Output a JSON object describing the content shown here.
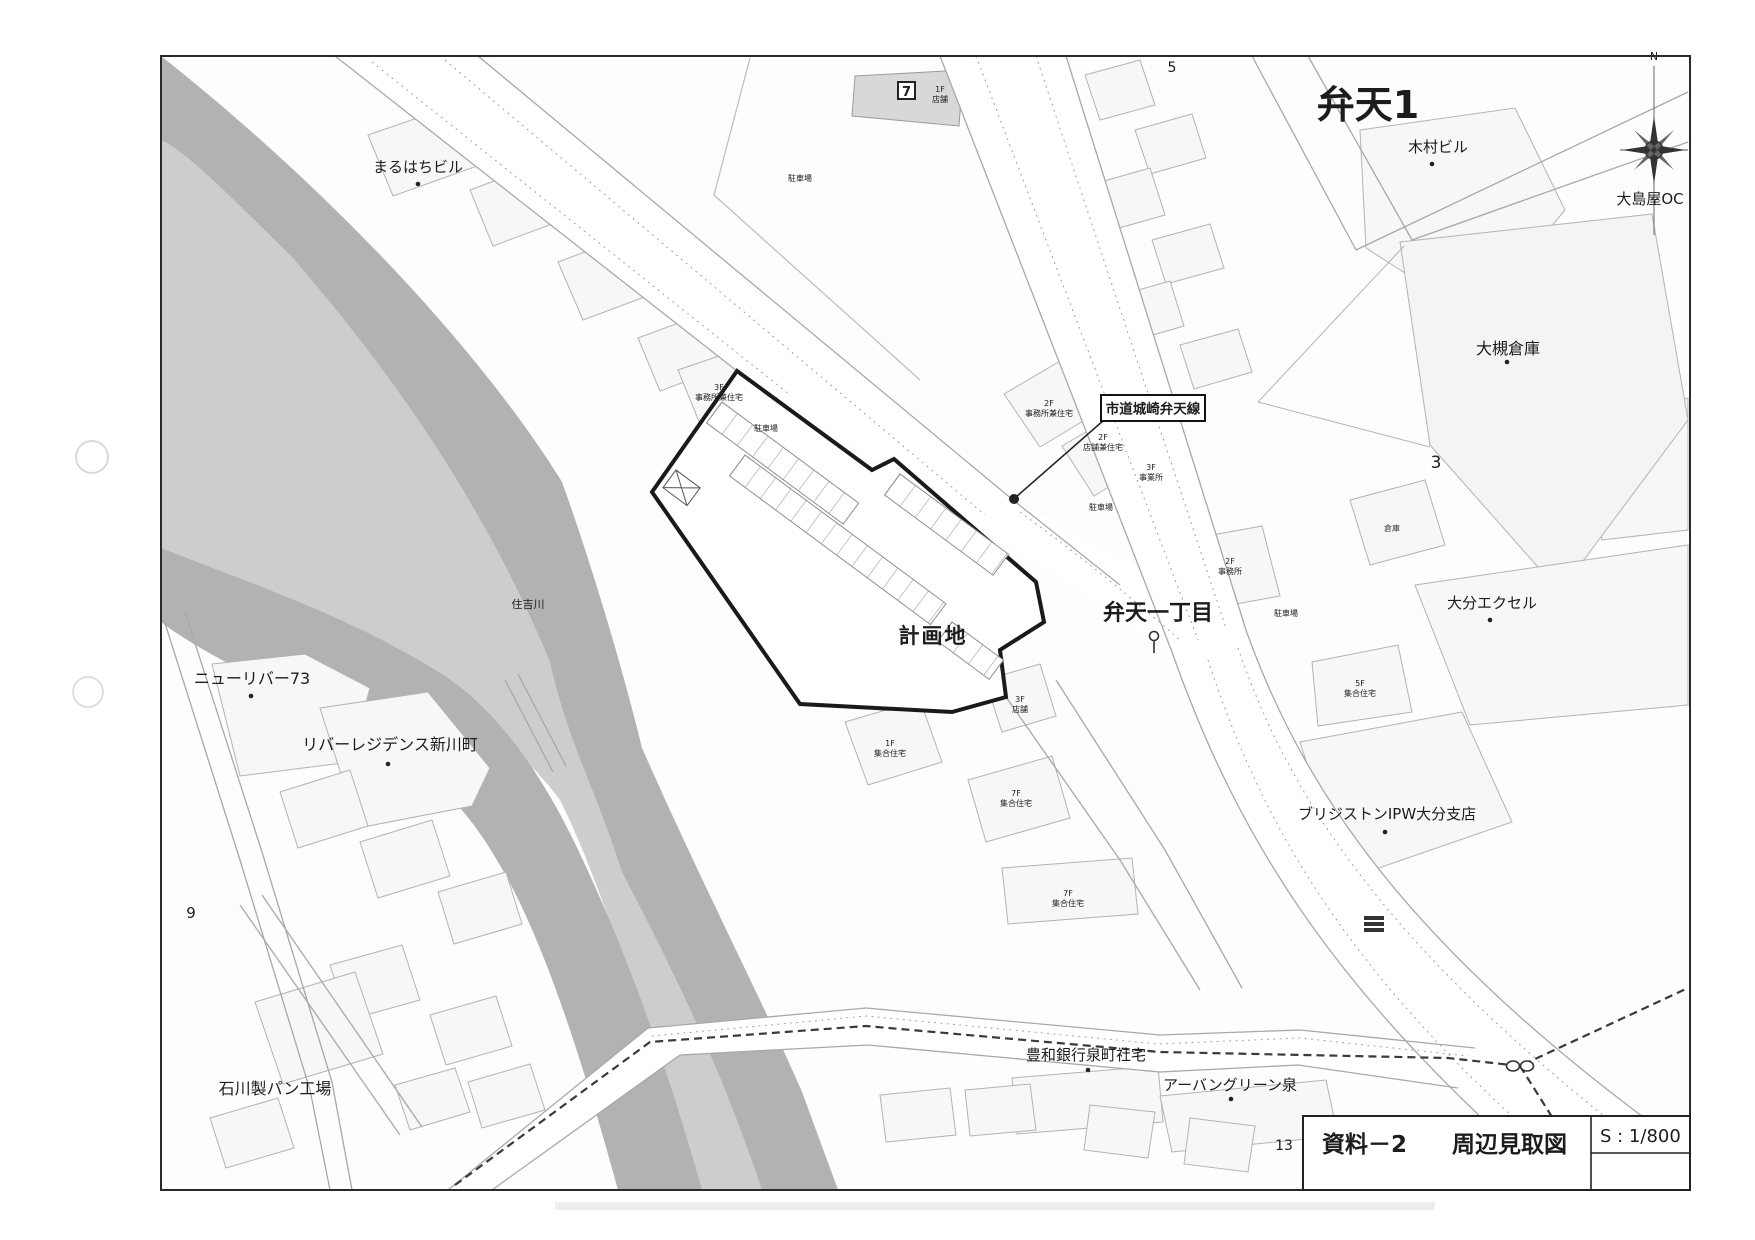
{
  "document": {
    "doc_no": "資料－2",
    "title": "周辺見取図",
    "scale": "S : 1/800"
  },
  "map": {
    "area_title": "弁天1",
    "district_label": "弁天一丁目",
    "site_label": "計画地",
    "road_callout": "市道城崎弁天線",
    "river_label": "住吉川",
    "compass_north": "N",
    "store_icon_glyph": "7",
    "block_numbers": {
      "five": "5",
      "three": "3",
      "nine": "9",
      "thirteen": "13"
    },
    "buildings": {
      "maruhachi": "まるはちビル",
      "kimura": "木村ビル",
      "oshimaya": "大島屋OC",
      "otsuki": "大槻倉庫",
      "souko": "倉庫",
      "newriver": "ニューリバー73",
      "riverres": "リバーレジデンス新川町",
      "ishikawa": "石川製パン工場",
      "howa": "豊和銀行泉町社宅",
      "urban": "アーバングリーン泉",
      "excel": "大分エクセル",
      "bridgestone": "ブリジストンIPW大分支店"
    },
    "small_labels": [
      {
        "l1": "3F",
        "l2": "事務所兼住宅"
      },
      {
        "l1": "駐車場"
      },
      {
        "l1": "2F",
        "l2": "事務所兼住宅"
      },
      {
        "l1": "2F",
        "l2": "店舗兼住宅"
      },
      {
        "l1": "3F",
        "l2": "事業所"
      },
      {
        "l1": "駐車場"
      },
      {
        "l1": "2F",
        "l2": "事務所"
      },
      {
        "l1": "駐車場"
      },
      {
        "l1": "5F",
        "l2": "集合住宅"
      },
      {
        "l1": "駐車場"
      },
      {
        "l1": "1F",
        "l2": "店舗"
      },
      {
        "l1": "3F",
        "l2": "店舗"
      },
      {
        "l1": "1F",
        "l2": "集合住宅"
      },
      {
        "l1": "7F",
        "l2": "集合住宅"
      },
      {
        "l1": "7F",
        "l2": "集合住宅"
      }
    ],
    "colors": {
      "river_channel": "#cdcdcd",
      "river_bank": "#b2b2b2",
      "parcel_fill": "#f7f7f7",
      "site_outline": "#1a1a1a"
    }
  }
}
